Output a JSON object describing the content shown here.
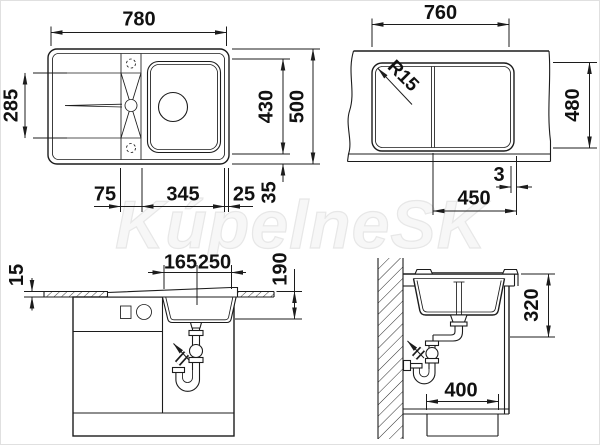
{
  "meta": {
    "watermark": "KúpelneSK"
  },
  "colors": {
    "line": "#1c1c1c",
    "text": "#111111",
    "watermark_fill": "#f7f7f7",
    "watermark_stroke": "#e7e7e7"
  },
  "plan_view": {
    "overall_width": "780",
    "drainer_depth": "285",
    "bowl_depth": "430",
    "overall_depth": "500",
    "ledge_width": "75",
    "bowl_width": "345",
    "right_edge": "25",
    "bottom_edge": "35"
  },
  "cutout_view": {
    "cutout_width": "760",
    "corner_radius": "R15",
    "cutout_depth": "480",
    "edge_gap": "3",
    "bowl_cutout_width": "450"
  },
  "front_view": {
    "worktop_thickness": "15",
    "drain_offset": "165",
    "bowl_width": "250",
    "bowl_depth": "190"
  },
  "section_view": {
    "drain_clearance": "320",
    "cabinet_depth": "400"
  }
}
